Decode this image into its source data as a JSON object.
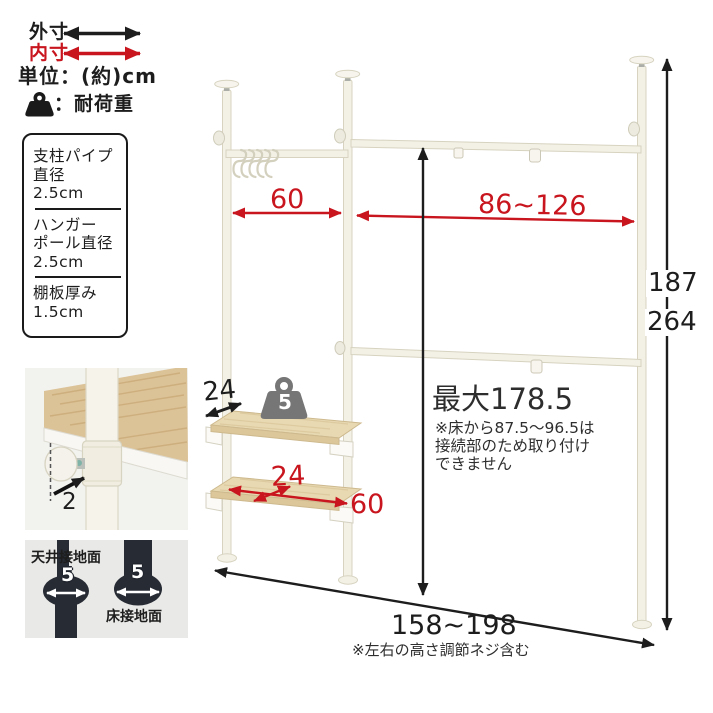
{
  "legend": {
    "outer_label": "外寸",
    "inner_label": "内寸",
    "unit_label": "単位：(約)cm",
    "load_label": "：耐荷重"
  },
  "spec_box": {
    "sections": [
      {
        "lines": [
          "支柱パイプ",
          "直径",
          "2.5cm"
        ]
      },
      {
        "lines": [
          "ハンガー",
          "ポール直径",
          "2.5cm"
        ]
      },
      {
        "lines": [
          "棚板厚み",
          "1.5cm"
        ]
      }
    ]
  },
  "closeup": {
    "pipe_gap": "2"
  },
  "contact": {
    "ceiling_label": "天井接地面",
    "ceiling_value": "5",
    "floor_label": "床接地面",
    "floor_value": "5"
  },
  "dims": {
    "hanger_width": "60",
    "extension_width": "86~126",
    "height_min": "187",
    "height_max": "264",
    "shelf_depth_outer": "24",
    "shelf_depth_inner": "24",
    "shelf_width": "60",
    "shelf_load": "5",
    "max_mount_height": "最大178.5",
    "mount_note_line1": "※床から87.5〜96.5は",
    "mount_note_line2": "接続部のため取り付け",
    "mount_note_line3": "できません",
    "total_width": "158~198",
    "total_width_note": "※左右の高さ調節ネジ含む"
  },
  "colors": {
    "inner_dim_red": "#c8151e",
    "outer_dim_black": "#1d1d1d",
    "pole_cream": "#f3f1e6",
    "wood": "#e8d9b3",
    "load_gray": "#767676",
    "silhouette_navy": "#272b34"
  }
}
